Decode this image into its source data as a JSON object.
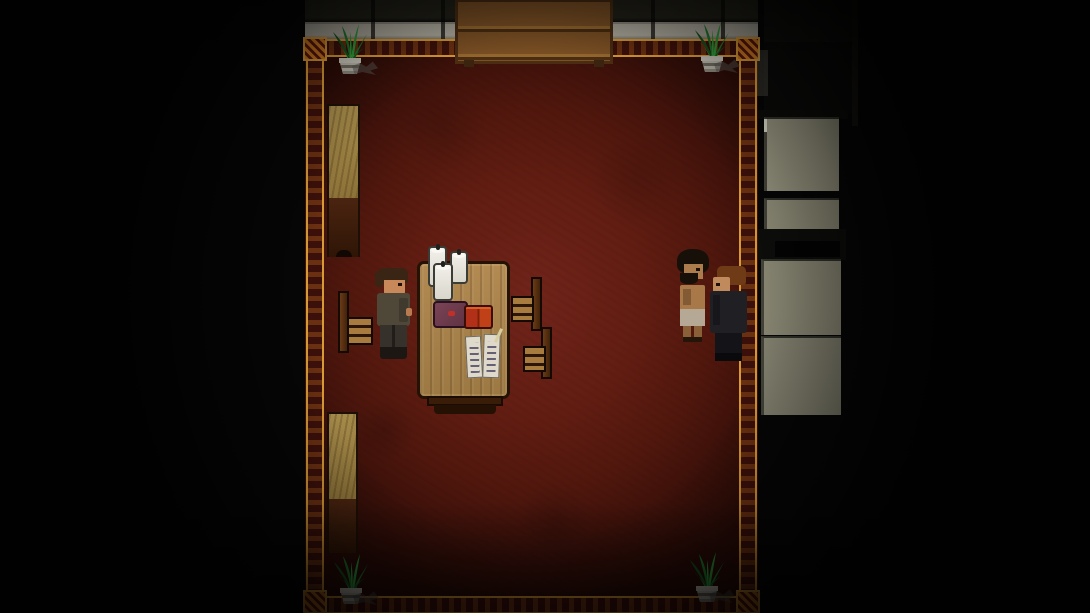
{
  "scene": {
    "environment": "dark-study-room",
    "entities": [
      "bookshelf",
      "potted-plant-top-left",
      "potted-plant-top-right",
      "potted-plant-bottom-left",
      "potted-plant-bottom-right",
      "wall-cabinet-upper",
      "wall-cabinet-lower",
      "reading-table",
      "candle-1",
      "candle-2",
      "candle-3",
      "purple-book",
      "red-tome-pair",
      "manuscript-pages",
      "quill",
      "chair-left",
      "chair-right-upper",
      "chair-right-lower",
      "player-character",
      "shirtless-npc",
      "dark-coat-npc",
      "side-room-panels",
      "ornate-gold-border"
    ]
  },
  "colors": {
    "floor_center": "#71241a",
    "floor_edge": "#2a0b06",
    "wall_gray": "#b3afa2",
    "border_gold": "#d89a34",
    "border_fill": "#3c100a",
    "corner_orange": "#d07822",
    "shelf_wood": "#7c5024",
    "table_outline": "#241204",
    "chair_wood": "#a87c3e",
    "paper_white": "#ded9cb",
    "tome_red": "#b23017",
    "tome_highlight": "#dd5f28",
    "panel_gray": "#95937e",
    "panel_gray2": "#8a8874",
    "panel_gray3": "#848270",
    "skin_warm": "#c8885a",
    "player_hair": "#3a2514",
    "player_jacket": "#4f4839",
    "player_pants": "#36312a",
    "player_boots": "#1c1712",
    "hermit_hair": "#161009",
    "hermit_skin": "#ad7c4c",
    "hermit_cloth": "#b5a996",
    "npc_hair": "#6e3b16",
    "npc_coat": "#201f24",
    "npc_pants": "#141318",
    "plant_green": "#1f7a2c",
    "plant_green_light": "#2f9e3c",
    "plant_green_dark": "#14541d",
    "pot_light": "#c6c2b6",
    "pot_dark": "#6e6a60"
  },
  "bookshelf": {
    "row1_colors": [
      "#2e5b2a",
      "#7a2014",
      "#15403a",
      "#b08a3c",
      "#5a2a10",
      "#24512a",
      "#8a2a1a",
      "#1c3a3a",
      "#6b4a1a",
      "#35621f",
      "#821d12",
      "#2a4d42",
      "#9a7a30",
      "#274f28"
    ],
    "row1_heights": [
      21,
      19,
      22,
      20,
      23,
      20,
      22,
      19,
      21,
      23,
      20,
      22,
      19,
      21
    ],
    "row2_colors": [
      "#1c3a3a",
      "#8a2a1a",
      "#2e5b2a",
      "#5a2a10",
      "#b08a3c",
      "#274f28",
      "#7a2014",
      "#15403a",
      "#6b4a1a",
      "#2a4d42",
      "#9a3020",
      "#24512a",
      "#6e1c10",
      "#35621f"
    ],
    "row2_heights": [
      19,
      21,
      18,
      20,
      19,
      21,
      18,
      20,
      19,
      21,
      18,
      20,
      19,
      21
    ]
  }
}
